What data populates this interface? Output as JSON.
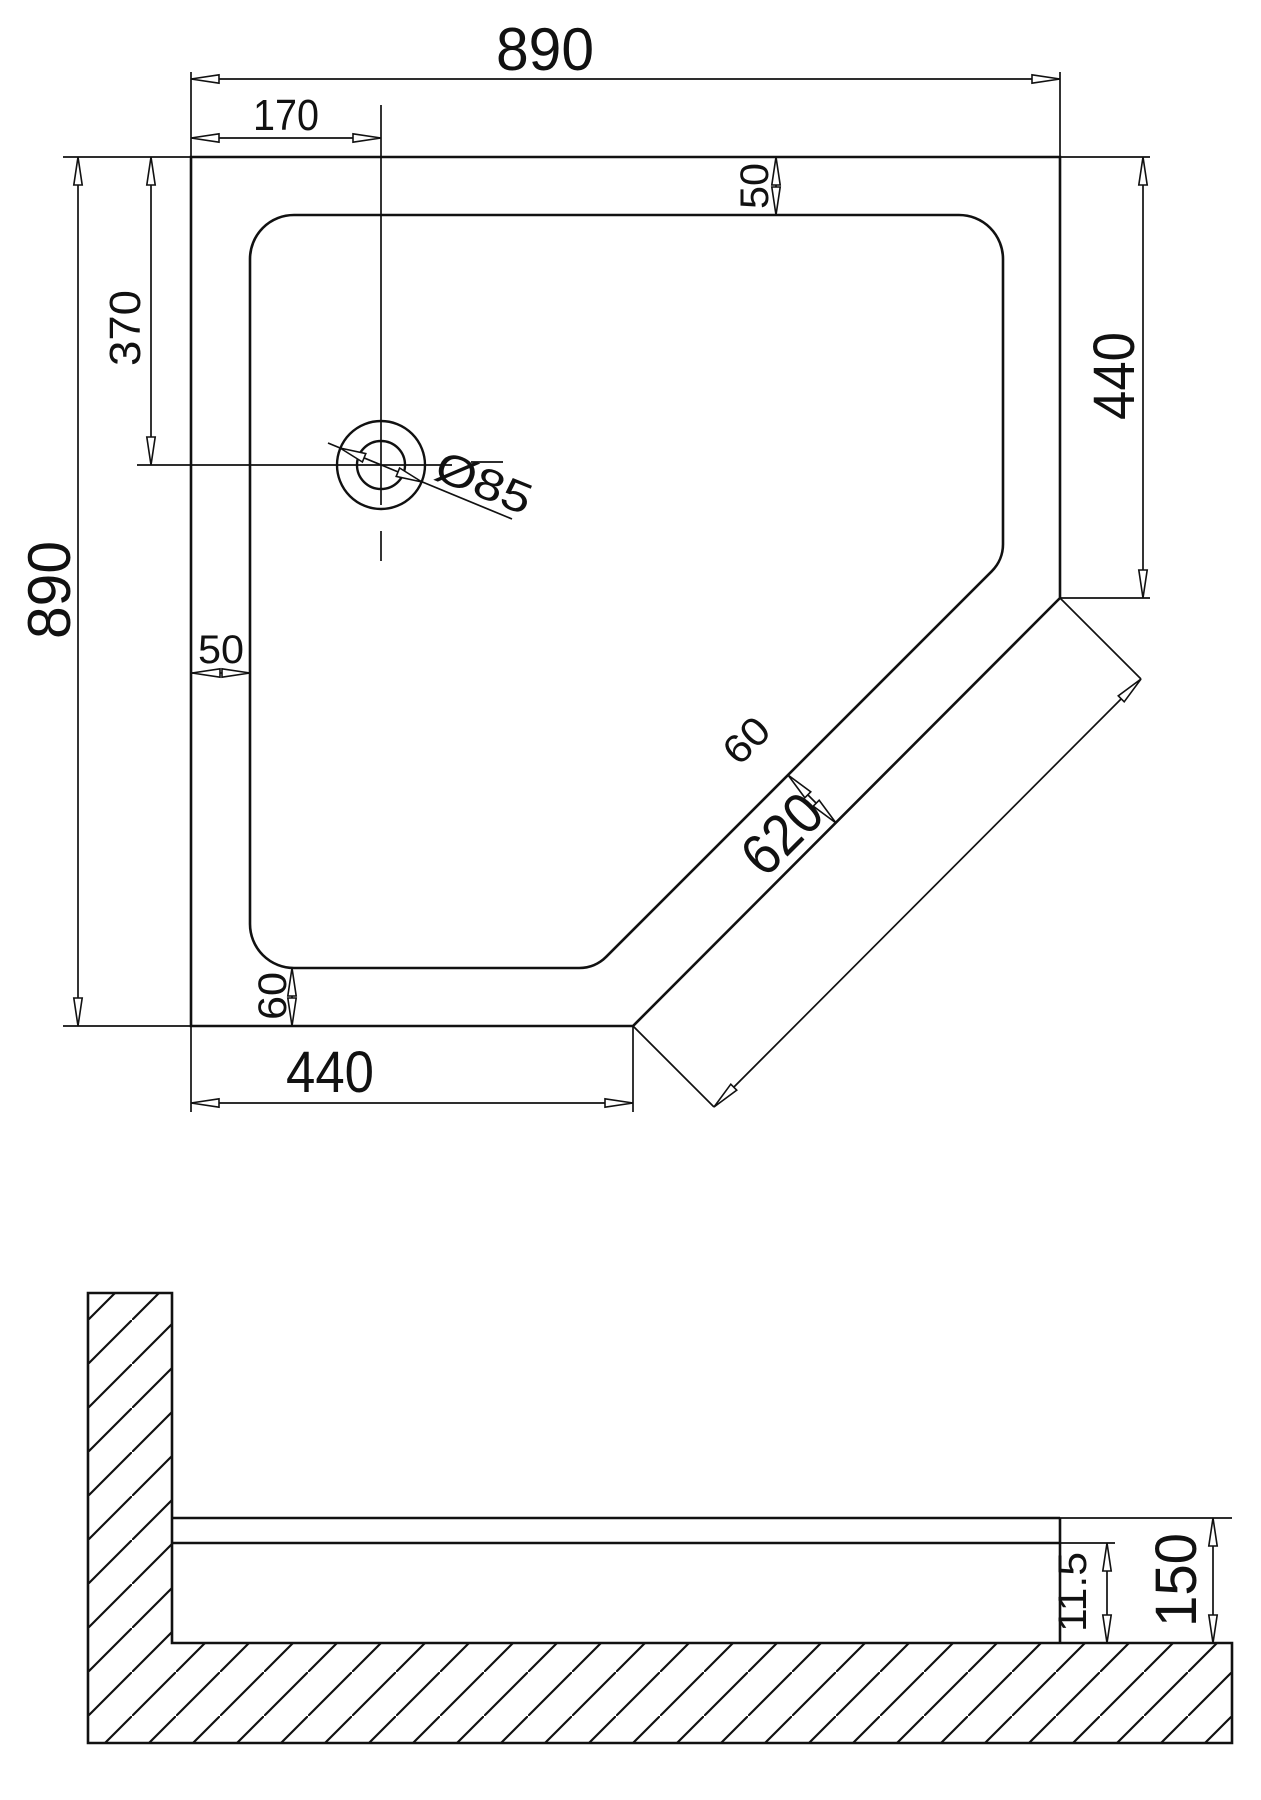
{
  "drawing": {
    "type": "shower-tray-technical-drawing",
    "line_color": "#111111",
    "background": "#ffffff",
    "plan_view": {
      "outer_width_top": "890",
      "drain_offset_x": "170",
      "outer_height_left": "890",
      "drain_offset_y": "370",
      "rim_top": "50",
      "right_edge_length": "440",
      "rim_left": "50",
      "rim_bottom": "60",
      "bottom_edge_length": "440",
      "diagonal_length": "620",
      "rim_diagonal": "60",
      "drain_diameter": "Ø85"
    },
    "section_view": {
      "tray_lip_height": "11.5",
      "total_height": "150"
    }
  }
}
